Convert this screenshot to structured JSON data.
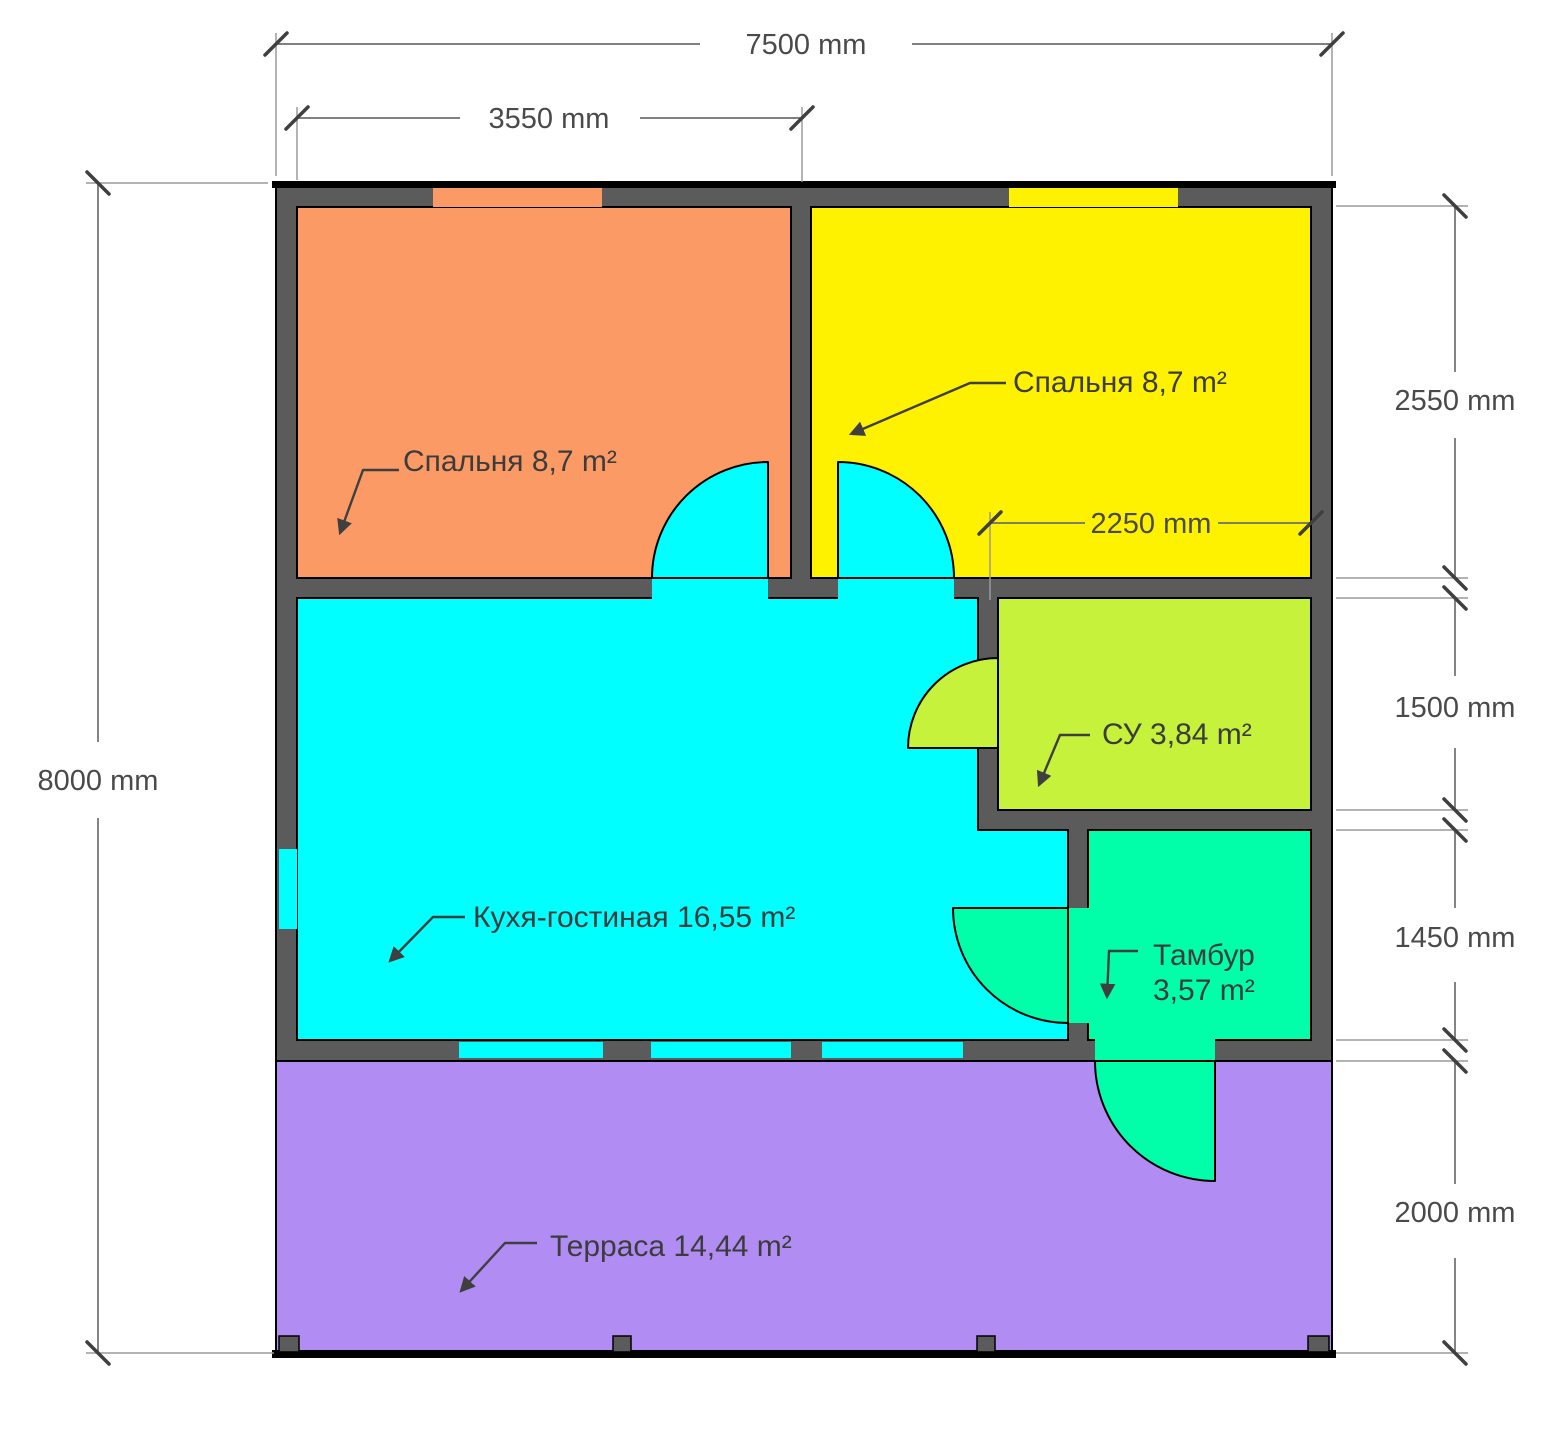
{
  "floor_plan": {
    "dimensions": {
      "overall_width": "7500 mm",
      "left_bedroom_width": "3550 mm",
      "overall_height": "8000 mm",
      "right_bedroom_height": "2550 mm",
      "bathroom_height": "1500 mm",
      "vestibule_height": "1450 mm",
      "terrace_height": "2000 mm",
      "right_bedroom_inner_width": "2250 mm"
    },
    "rooms": [
      {
        "name": "bedroom-left",
        "label": "Спальня 8,7 m²",
        "color": "#FC9A66"
      },
      {
        "name": "bedroom-right",
        "label": "Спальня 8,7 m²",
        "color": "#FFF200"
      },
      {
        "name": "kitchen-living",
        "label": "Кухя-гостиная 16,55 m²",
        "color": "#00FFFF"
      },
      {
        "name": "bathroom",
        "label": "СУ 3,84 m²",
        "color": "#C6F23C"
      },
      {
        "name": "vestibule",
        "label": "Тамбур",
        "label2": "3,57 m²",
        "color": "#00FFA8"
      },
      {
        "name": "terrace",
        "label": "Терраса 14,44 m²",
        "color": "#B18CF2"
      }
    ],
    "colors": {
      "wall": "#5B5B5B",
      "outline": "#000000",
      "dimension_text": "#4A4A4A",
      "label_text": "#3C3C3C"
    }
  }
}
